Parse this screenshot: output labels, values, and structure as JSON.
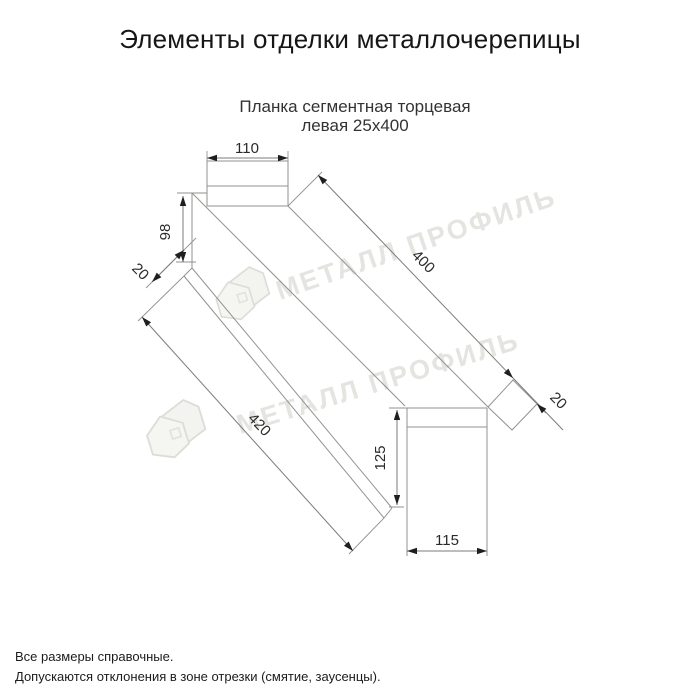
{
  "page": {
    "background": "#ffffff"
  },
  "header": {
    "title": "Элементы отделки металлочерепицы"
  },
  "drawing": {
    "subtitle_line1": "Планка сегментная торцевая",
    "subtitle_line2": "левая 25х400",
    "dimensions": {
      "top_width": "110",
      "left_height": "98",
      "left_fold": "20",
      "length_top": "400",
      "right_fold": "20",
      "length_bottom": "420",
      "end_height": "125",
      "end_width": "115"
    },
    "line_color": "#94928f",
    "dim_line_color": "#7d7b78",
    "arrow_color": "#1f1f1f",
    "label_color": "#2a2a2a"
  },
  "watermark": {
    "text": "МЕТАЛЛ ПРОФИЛЬ",
    "text_color": "#e4e4e1",
    "logo_color": "#dcdcd8"
  },
  "footer": {
    "line1": "Все размеры справочные.",
    "line2": "Допускаются отклонения в зоне отрезки (смятие, заусенцы)."
  }
}
